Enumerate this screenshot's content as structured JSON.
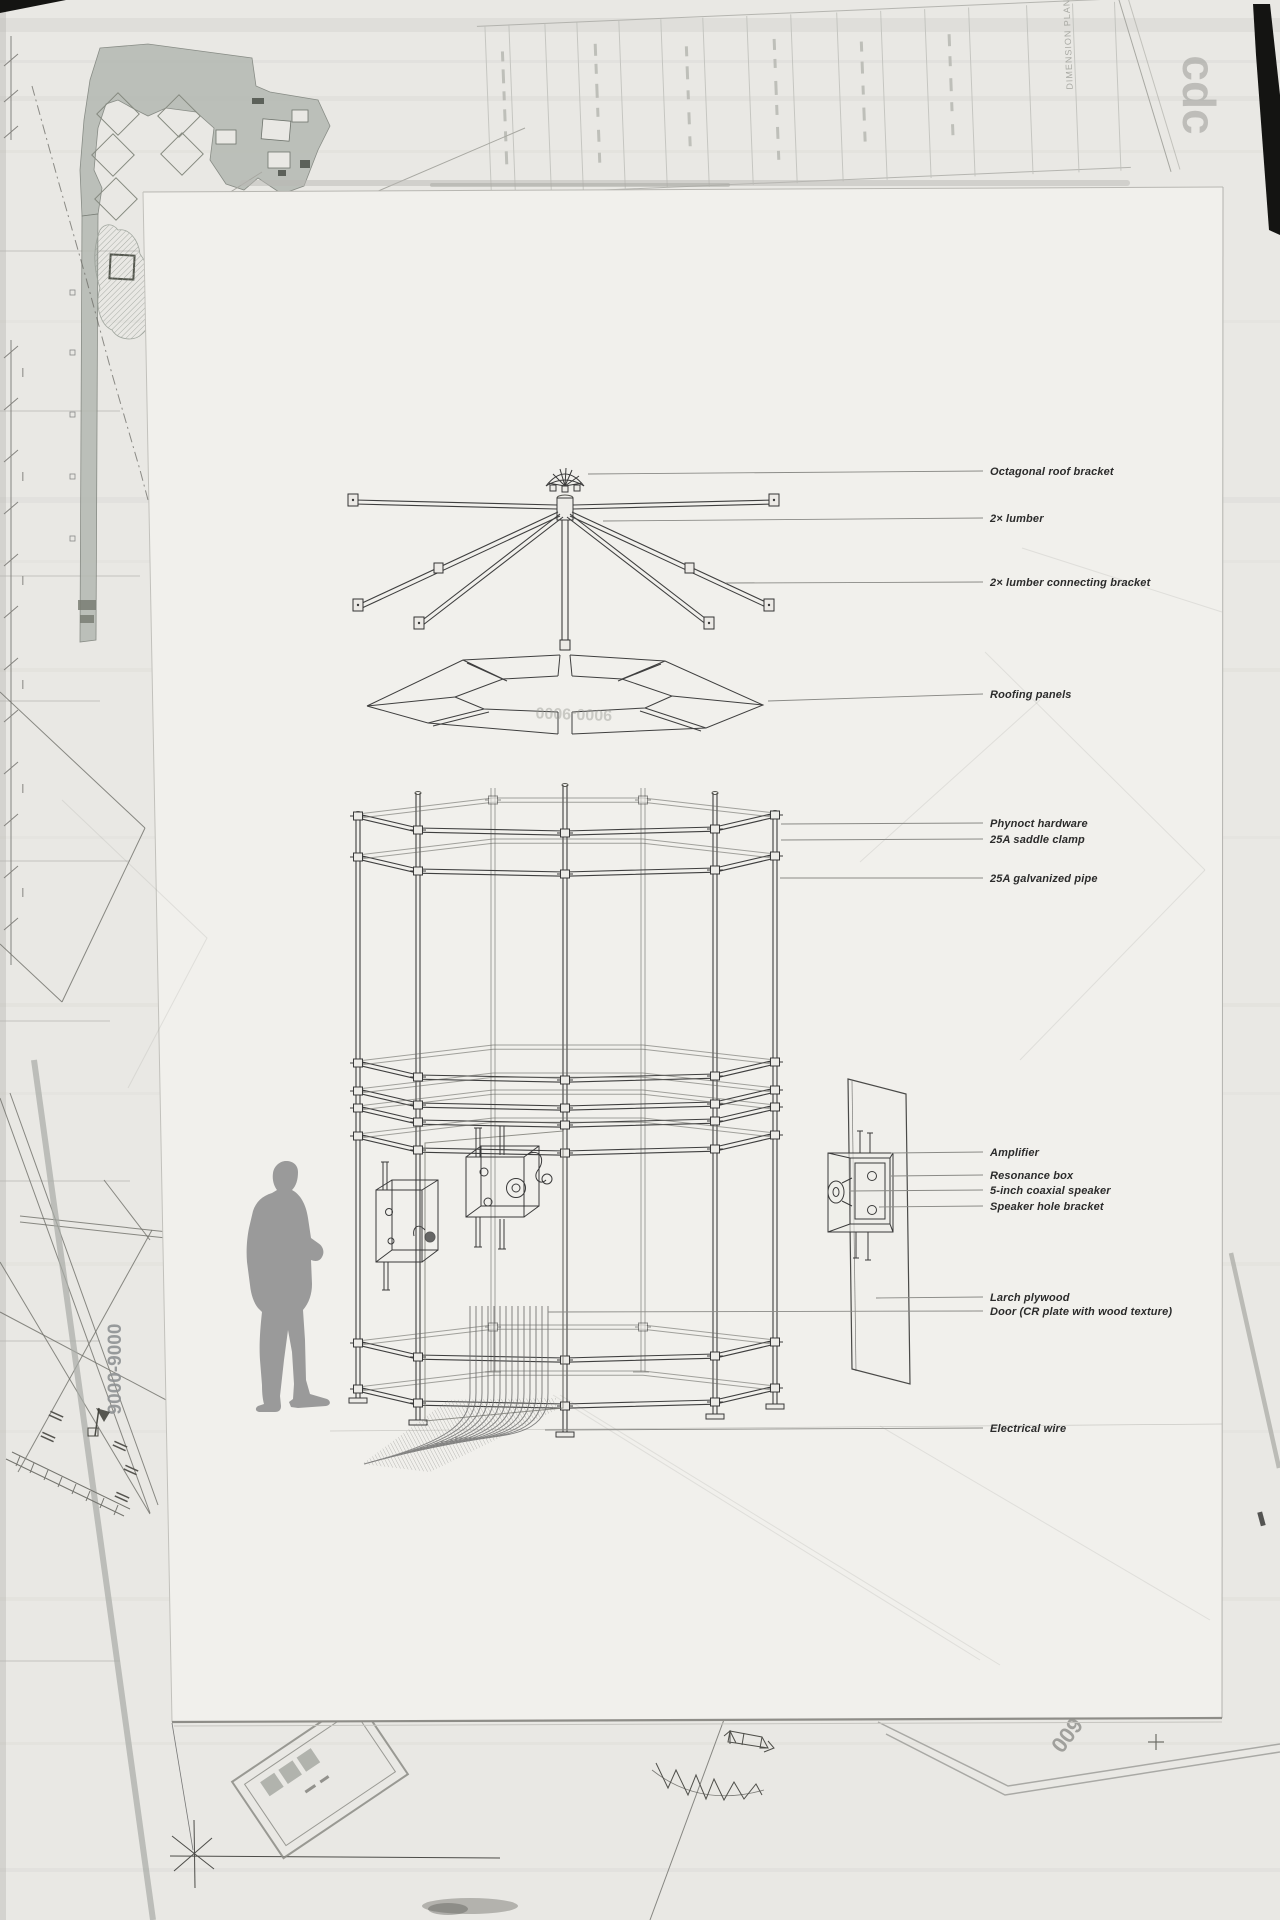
{
  "labels": [
    {
      "text": "Octagonal roof bracket"
    },
    {
      "text": "2× lumber"
    },
    {
      "text": "2× lumber connecting bracket"
    },
    {
      "text": "Roofing panels"
    },
    {
      "text": "Phynoct hardware"
    },
    {
      "text": "25A saddle clamp"
    },
    {
      "text": "25A galvanized pipe"
    },
    {
      "text": "Amplifier"
    },
    {
      "text": "Resonance box"
    },
    {
      "text": "5-inch coaxial speaker"
    },
    {
      "text": "Speaker hole bracket"
    },
    {
      "text": "Larch plywood"
    },
    {
      "text": "Door (CR plate with wood texture)"
    },
    {
      "text": "Electrical wire"
    }
  ],
  "watermarks": {
    "stamp": "cdc",
    "roof_panel_ghost": "9000-9000",
    "left_margin_vertical": "9000-9000",
    "bottom_right": "600",
    "title_block_column": "DIMENSION PLAN"
  },
  "colors": {
    "paper": "#e9e8e4",
    "sheet": "#f1f0ec",
    "ink": "#3d3d3d",
    "silhouette": "#9a9a9a",
    "siteplan_fill": "#b4b9b2",
    "black_accent": "#141412"
  }
}
